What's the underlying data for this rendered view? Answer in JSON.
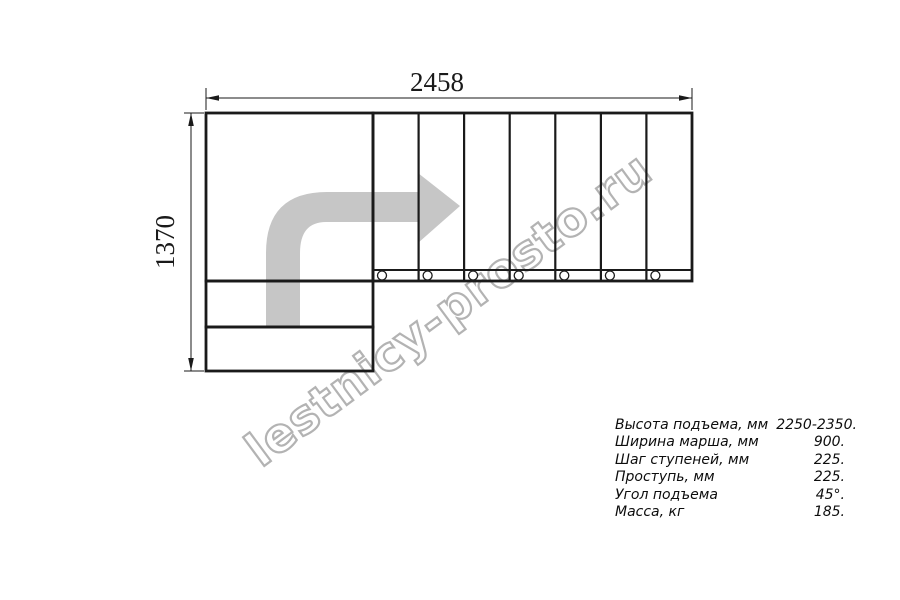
{
  "drawing": {
    "title": "L-shaped staircase plan (top view)",
    "dim_width": {
      "label": "2458"
    },
    "dim_height": {
      "label": "1370"
    },
    "stair_facts": {
      "treads_in_straight_flight": 7,
      "landing_steps_below": 2,
      "direction_arrow": "up-then-right"
    }
  },
  "watermark": {
    "text": "lestnicy-prosto.ru"
  },
  "specs": {
    "rows": [
      {
        "label": "Высота подъема, мм",
        "value": "2250-2350."
      },
      {
        "label": "Ширина марша, мм",
        "value": "900."
      },
      {
        "label": "Шаг ступеней, мм",
        "value": "225."
      },
      {
        "label": "Проступь, мм",
        "value": "225."
      },
      {
        "label": "Угол подъема",
        "value": "45°."
      },
      {
        "label": "Масса, кг",
        "value": "185."
      }
    ]
  },
  "colors": {
    "line": "#1a1a1a",
    "arrow_fill": "#c6c6c6",
    "watermark_stroke": "#b3b3b3",
    "background": "#ffffff"
  }
}
